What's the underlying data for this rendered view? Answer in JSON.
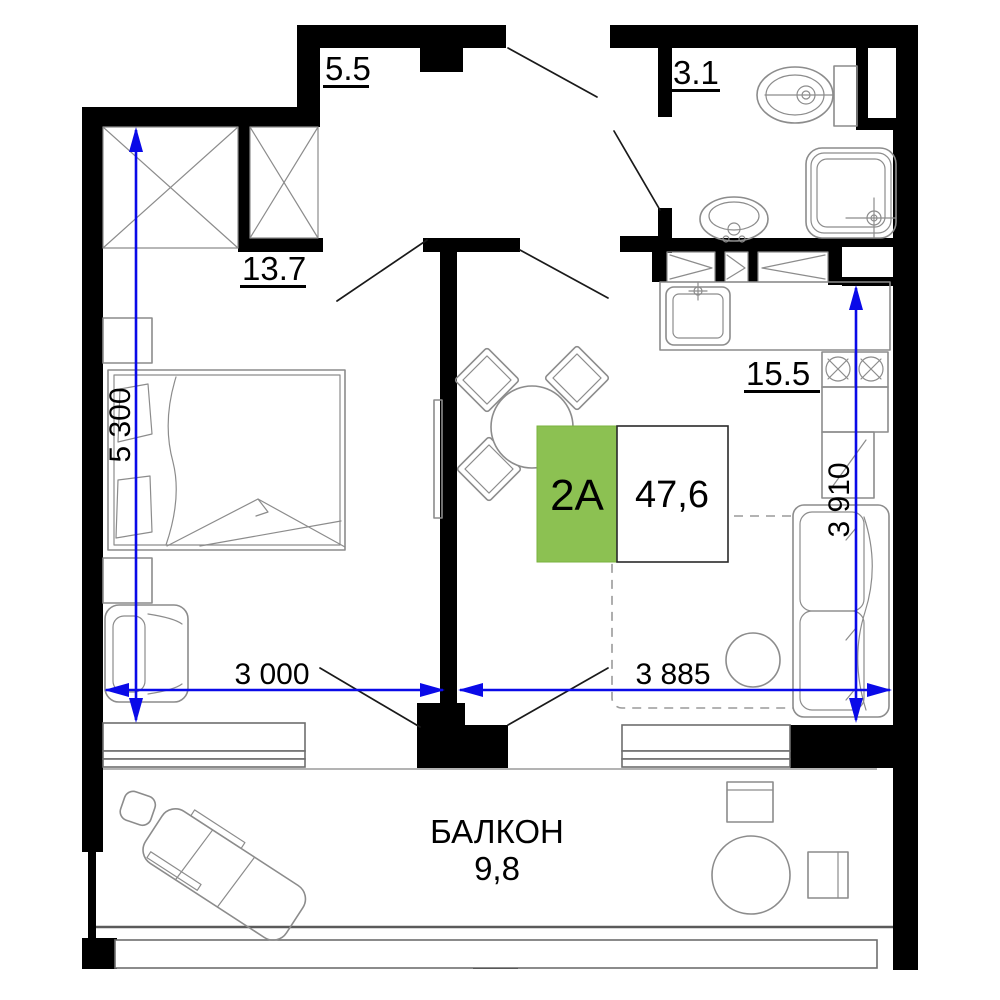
{
  "title": "Floor plan — unit 2A",
  "plan": {
    "badge": {
      "code": "2A",
      "total_area": "47,6"
    },
    "rooms": {
      "hallway": {
        "area": "5.5"
      },
      "bathroom": {
        "area": "3.1"
      },
      "bedroom": {
        "area": "13.7"
      },
      "kitchen_living": {
        "area": "15.5"
      },
      "balcony": {
        "name": "БАЛКОН",
        "area": "9,8"
      }
    },
    "dimensions": {
      "left_height": "5 300",
      "bedroom_width": "3 000",
      "living_width": "3 885",
      "kitchen_height": "3 910"
    },
    "colors": {
      "badge_green": "#8CC152",
      "dimension_blue": "#0A0AE8",
      "wall_black": "#000000",
      "furniture_gray": "#8C8C8C"
    }
  }
}
